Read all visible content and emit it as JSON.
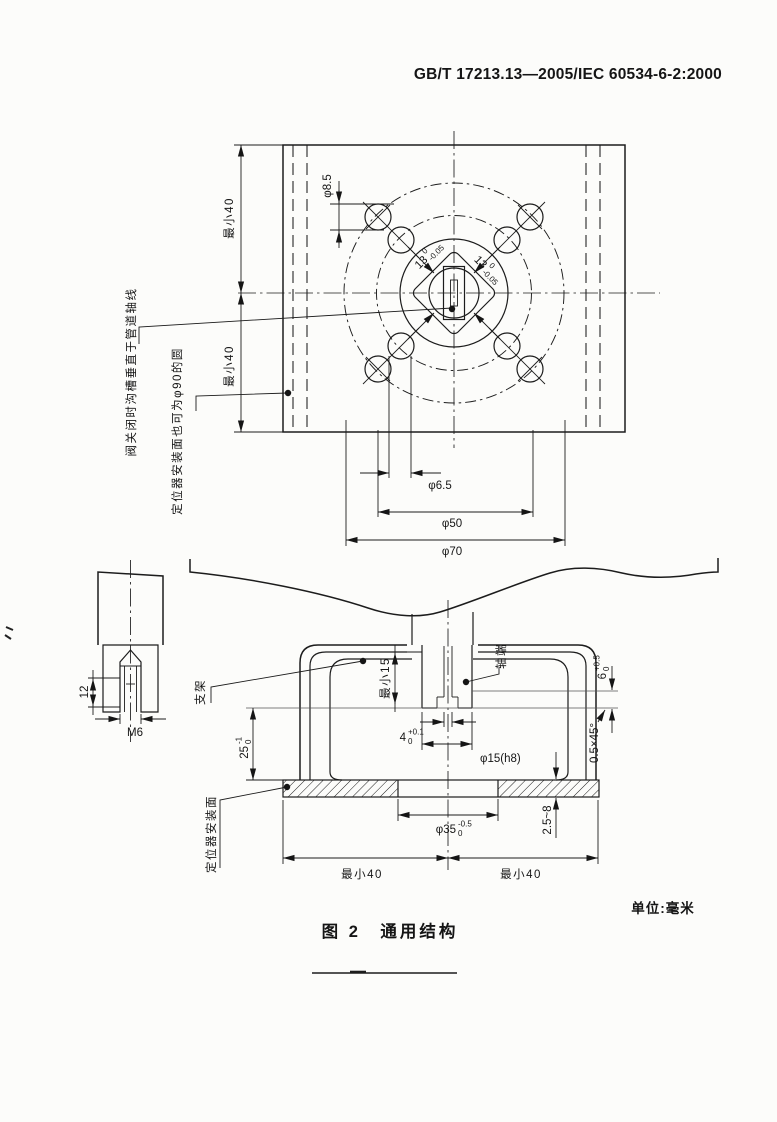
{
  "page": {
    "header": "GB/T 17213.13—2005/IEC 60534-6-2:2000",
    "caption": "图 2　通用结构",
    "units": "单位:毫米"
  },
  "top_view": {
    "hole_dia": "φ8.5",
    "min40_upper": "最小40",
    "min40_lower": "最小40",
    "square_left": {
      "main": "13",
      "sup": "0",
      "sub": "-0.05"
    },
    "square_right": {
      "main": "13",
      "sup": "0",
      "sub": "-0.05"
    },
    "phi65": "φ6.5",
    "phi50": "φ50",
    "phi70": "φ70",
    "groove_note": "阀关闭时沟槽垂直于管道轴线",
    "mount_note": "定位器安装面也可为φ90的圆"
  },
  "front_view": {
    "dim12": "12",
    "thread": "M6",
    "bracket_label": "支架",
    "min15": "最小15",
    "shaft_end": "轴端",
    "slot4": {
      "main": "4",
      "sup": "+0.1",
      "sub": "0"
    },
    "shaft_dia": "φ15(h8)",
    "dim6": {
      "main": "6",
      "sup": "+0.5",
      "sub": "0"
    },
    "chamfer": "0.5×45°",
    "dim25": {
      "main": "25",
      "sup": "-1",
      "sub": "0"
    },
    "flange_thk": "2.5~8",
    "spigot": {
      "main": "φ35",
      "sup": "-0.5",
      "sub": "0"
    },
    "min40_left": "最小40",
    "min40_right": "最小40",
    "mount_face": "定位器安装面"
  }
}
